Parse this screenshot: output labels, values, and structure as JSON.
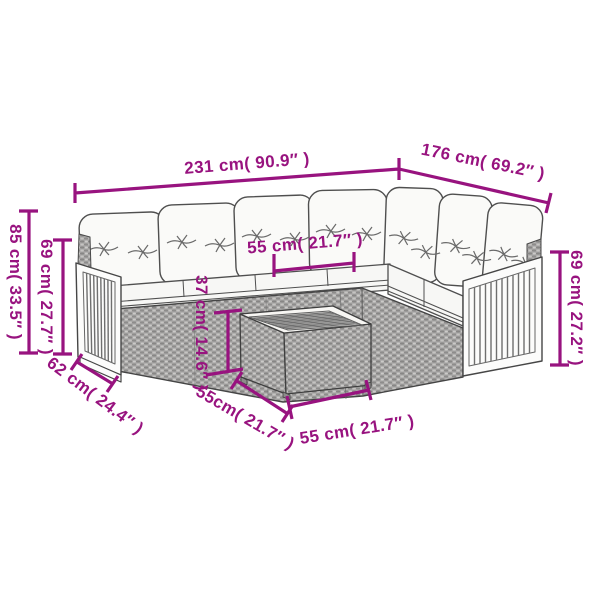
{
  "colors": {
    "accent": "#98137f",
    "outline": "#4a4a4a",
    "rattan": "#adacab",
    "cushion": "#f8f8f6"
  },
  "illustration": {
    "description": "line-art of a 7-seat L-shaped poly rattan garden corner sofa with white cushions, wooden slatted armrests and a square rattan side table with slatted wooden top",
    "pillow_count": 7
  },
  "dimensions": {
    "sofa_width_left": "231 cm( 90.9″ )",
    "sofa_width_right": "176 cm( 69.2″ )",
    "back_height": "85 cm( 33.5″ )",
    "arm_height_left": "69 cm( 27.7″ )",
    "seat_depth": "62 cm( 24.4″ )",
    "seat_width": "55 cm( 21.7″ )",
    "table_height": "37 cm( 14.6″ )",
    "table_depth": "55cm( 21.7″ )",
    "table_width": "55 cm( 21.7″ )",
    "arm_height_right": "69 cm( 27.2″ )"
  }
}
